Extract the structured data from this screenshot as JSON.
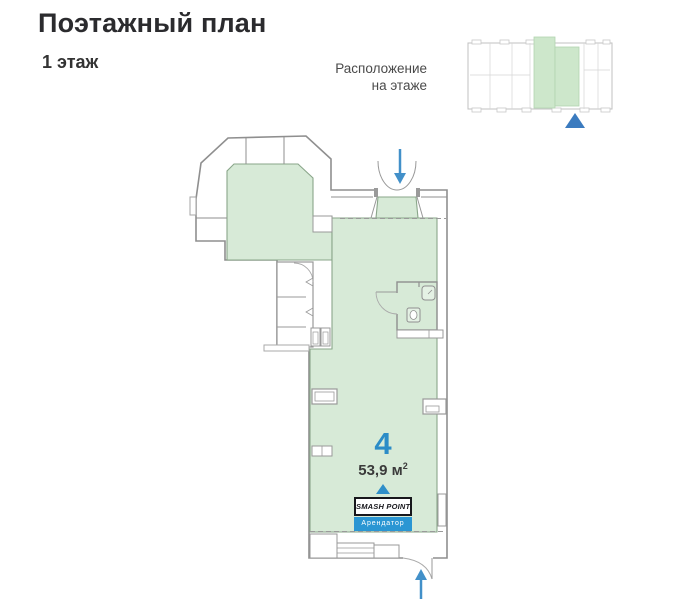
{
  "page": {
    "title": "Поэтажный план",
    "subtitle": "1 этаж"
  },
  "minimap": {
    "caption_line1": "Расположение",
    "caption_line2": "на этаже",
    "highlight_color": "#cde7cb",
    "outline_color": "#c0c0c0",
    "pointer_color": "#3b7bbf"
  },
  "unit": {
    "number": "4",
    "area_label": "53,9 м",
    "area_sup": "2",
    "tenant_name": "SMASH POINT",
    "tenant_label": "Арендатор"
  },
  "plan": {
    "fill_green": "#d7ead7",
    "wall_gray": "#8f8f8f",
    "arrow_blue": "#4290c9"
  },
  "colors": {
    "accent_blue": "#2b8cc7",
    "tenant_blue": "#2a96d3",
    "title_dark": "#2b2b2e"
  }
}
